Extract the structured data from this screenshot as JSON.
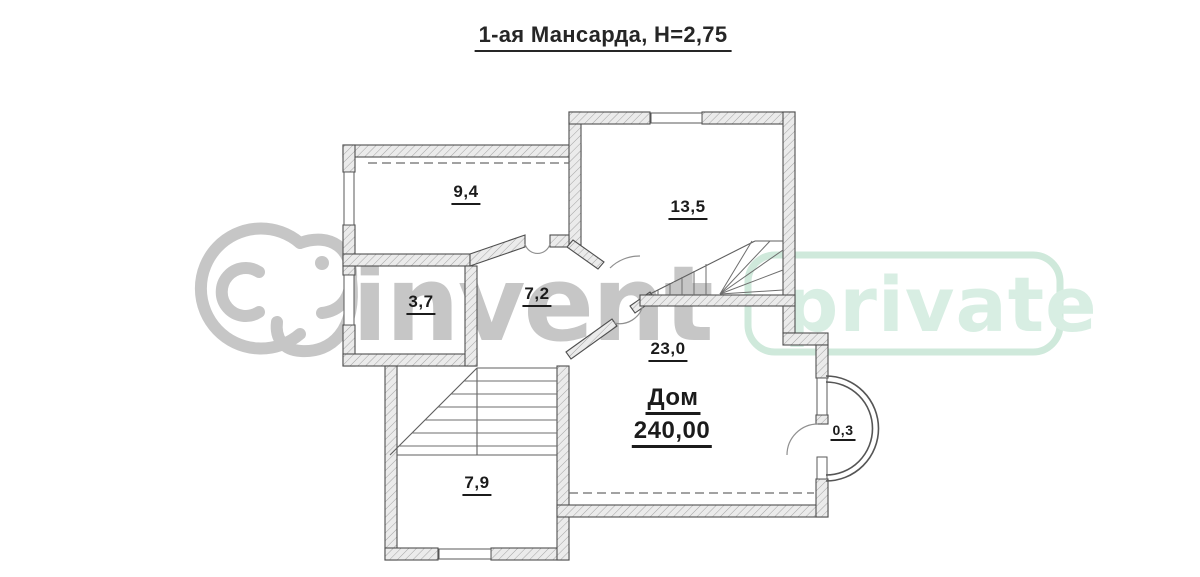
{
  "title": "1-ая Мансарда, Н=2,75",
  "rooms": {
    "room_9_4": "9,4",
    "room_13_5": "13,5",
    "room_3_7": "3,7",
    "room_7_2": "7,2",
    "room_23_0": "23,0",
    "room_7_9": "7,9",
    "bay_0_3": "0,3",
    "house_name": "Дом",
    "house_area": "240,00"
  },
  "watermarks": {
    "brand_text": "invent",
    "badge_text": "private",
    "brand_color": "#c6c6c6",
    "badge_color": "#d8eee3",
    "badge_border_color": "#cfe9db"
  },
  "colors": {
    "wall_stroke": "#4f4f4f",
    "hatch_fill": "#ebebeb",
    "hatch_line": "#a3a3a3",
    "label_color": "#1b1b1b",
    "background": "#ffffff"
  }
}
